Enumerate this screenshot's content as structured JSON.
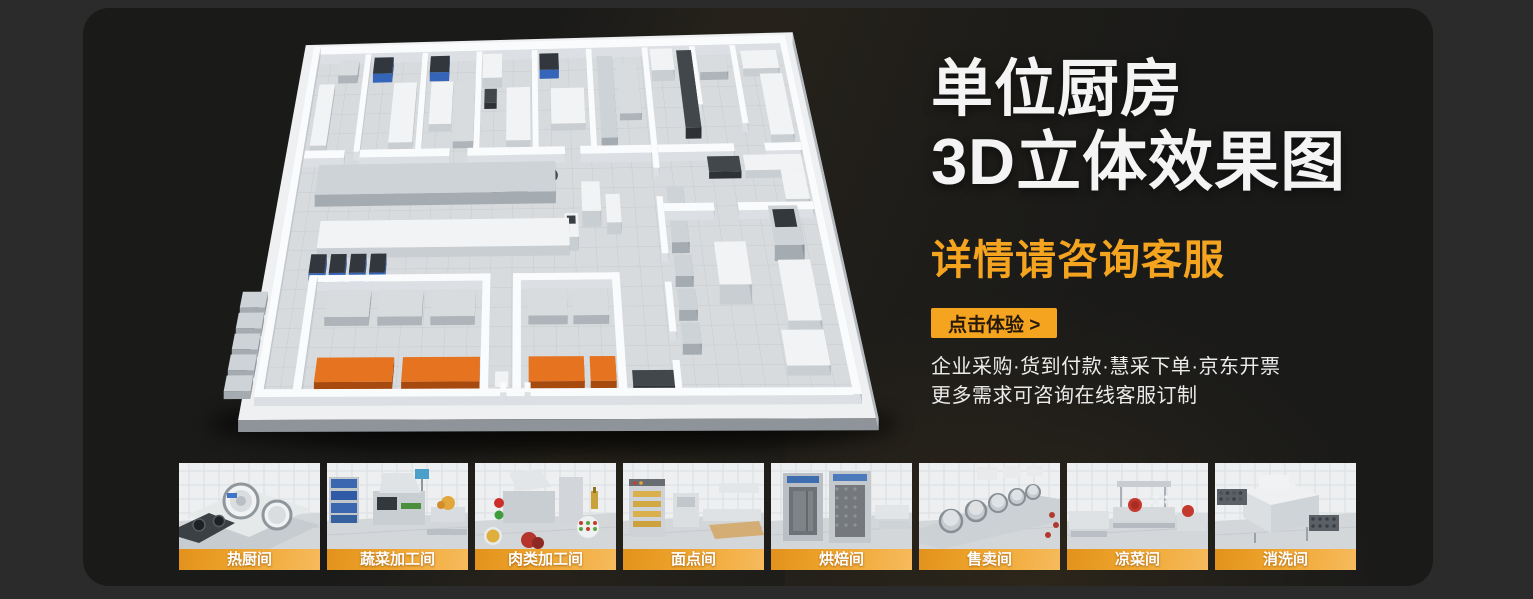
{
  "hero": {
    "title_line1": "单位厨房",
    "title_line2": "3D立体效果图",
    "subtitle": "详情请咨询客服",
    "cta_label": "点击体验 >",
    "note_line1": "企业采购·货到付款·慧采下单·京东开票",
    "note_line2": "更多需求可咨询在线客服订制"
  },
  "colors": {
    "accent_orange": "#f5a41f",
    "page_background": "#2b2b2b",
    "panel_background": "#1a1a19",
    "label_gradient_start": "#e2921c",
    "label_gradient_end": "#f6bb5e"
  },
  "gallery": {
    "items": [
      {
        "label": "热厨间",
        "icon": "hot-kitchen-thumbnail"
      },
      {
        "label": "蔬菜加工间",
        "icon": "vegetable-processing-thumbnail"
      },
      {
        "label": "肉类加工间",
        "icon": "meat-processing-thumbnail"
      },
      {
        "label": "面点间",
        "icon": "pastry-room-thumbnail"
      },
      {
        "label": "烘焙间",
        "icon": "baking-room-thumbnail"
      },
      {
        "label": "售卖间",
        "icon": "serving-room-thumbnail"
      },
      {
        "label": "凉菜间",
        "icon": "cold-dish-room-thumbnail"
      },
      {
        "label": "消洗间",
        "icon": "dishwashing-room-thumbnail"
      }
    ]
  }
}
